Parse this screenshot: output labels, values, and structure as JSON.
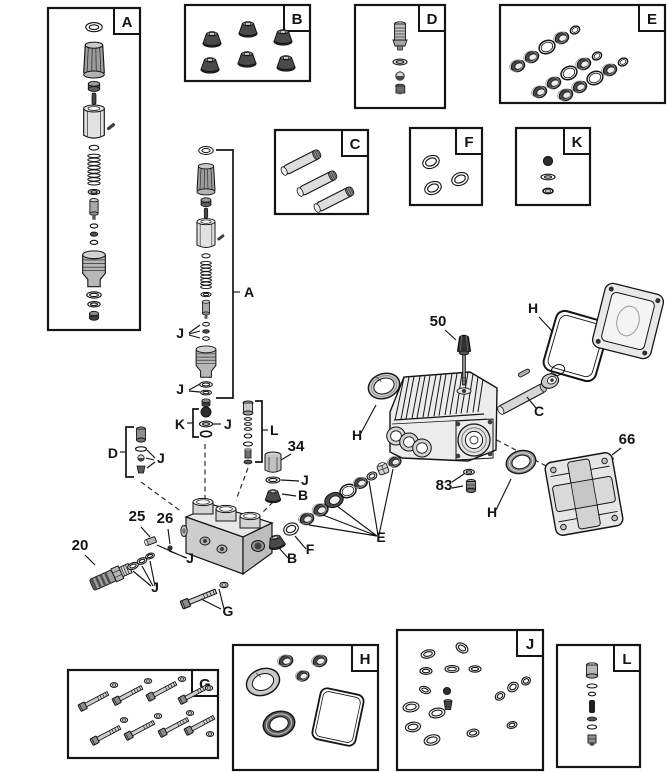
{
  "labels": {
    "A": "A",
    "B": "B",
    "C": "C",
    "D": "D",
    "E": "E",
    "F": "F",
    "G": "G",
    "H": "H",
    "J": "J",
    "K": "K",
    "L": "L"
  },
  "parts": {
    "n20": "20",
    "n25": "25",
    "n26": "26",
    "n34": "34",
    "n50": "50",
    "n66": "66",
    "n83": "83"
  },
  "colors": {
    "background": "#ffffff",
    "line": "#141414",
    "metal_light": "#e6e6e6",
    "metal_mid": "#9c9c9c",
    "metal_dark": "#3a3a3a"
  }
}
